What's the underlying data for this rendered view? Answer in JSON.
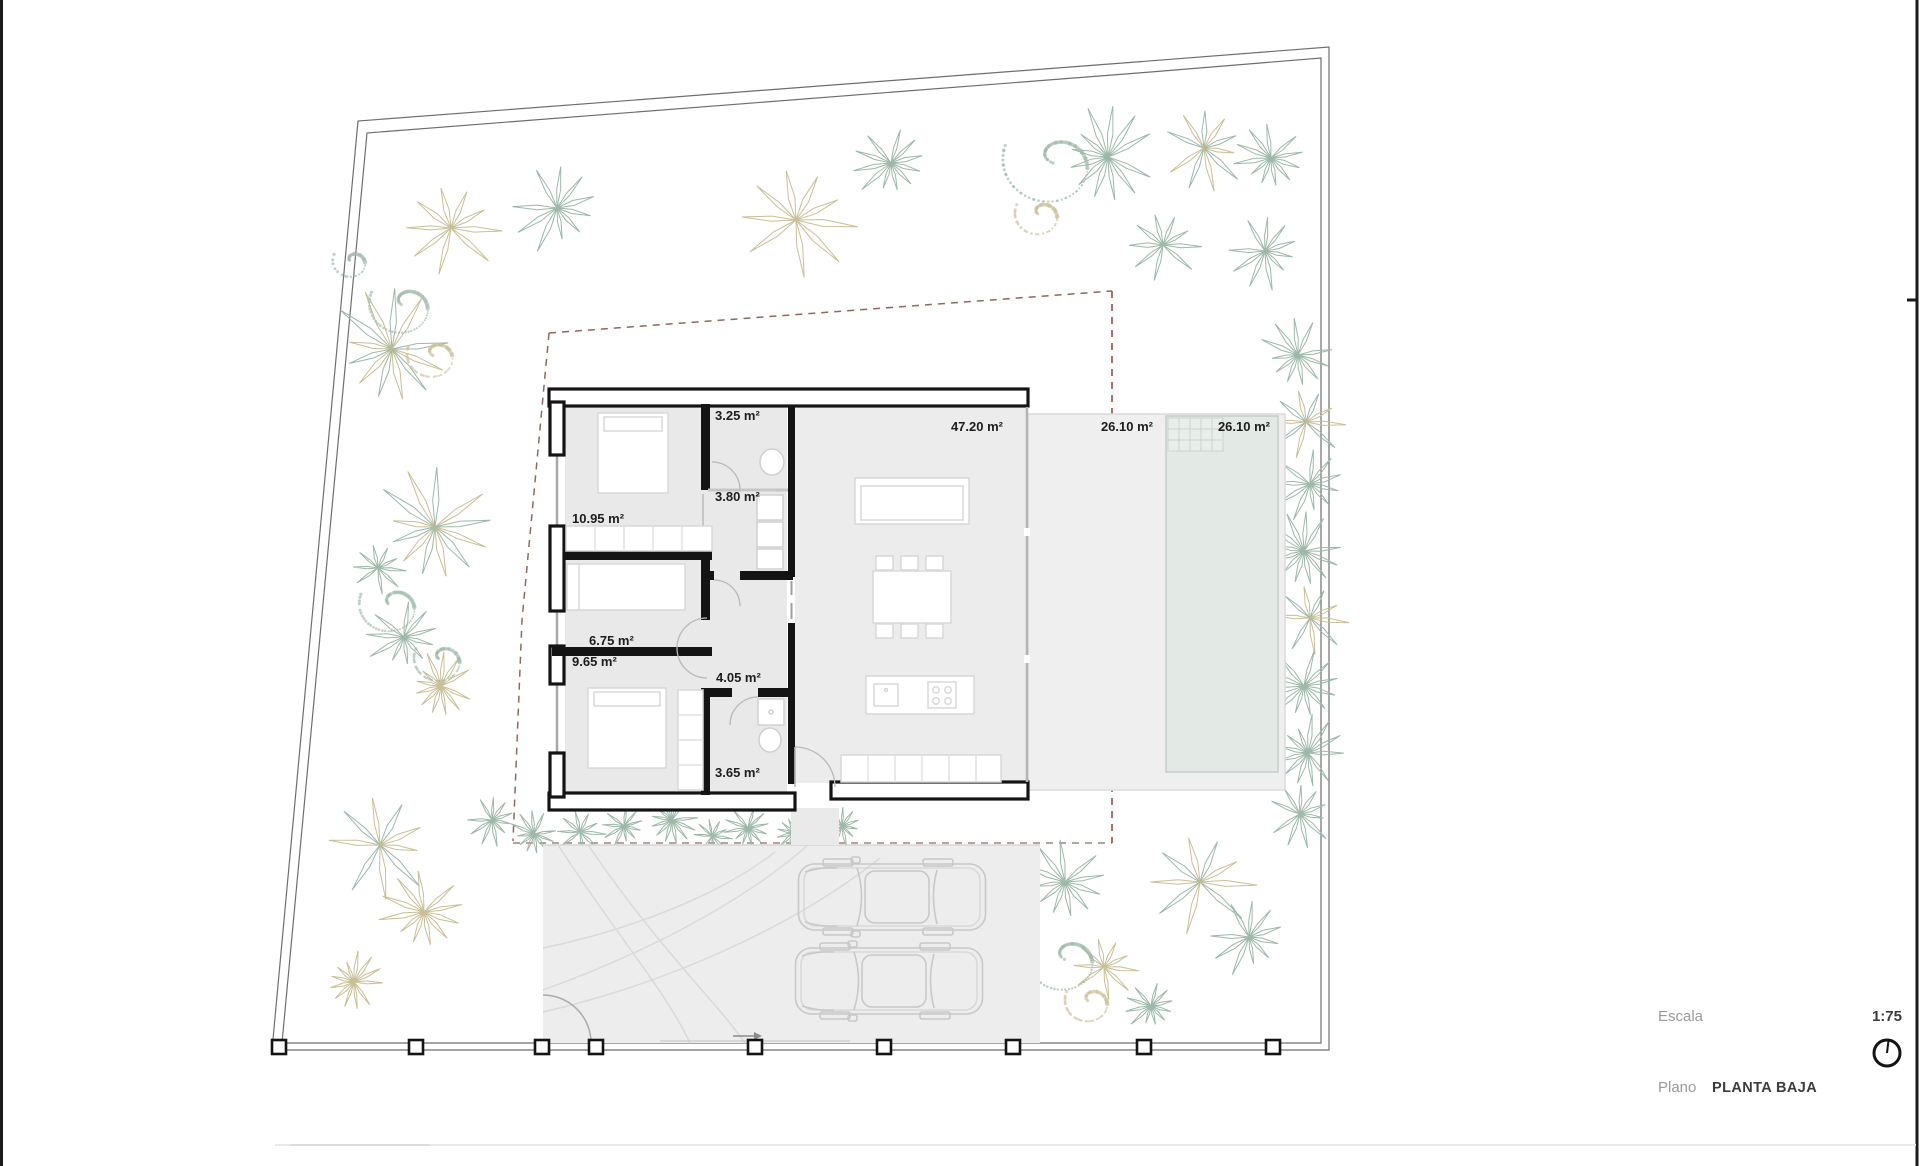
{
  "document": {
    "type": "architectural-floor-plan-sheet"
  },
  "title_block": {
    "escala_label": "Escala",
    "escala_value": "1:75",
    "plano_label": "Plano",
    "plano_value": "PLANTA BAJA",
    "north_icon": "north-compass-circle"
  },
  "plan": {
    "room_labels": [
      {
        "name": "bathroom-1",
        "area": "3.25 m²",
        "x": 715,
        "y": 420,
        "anchor": "start"
      },
      {
        "name": "laundry-hall",
        "area": "3.80 m²",
        "x": 715,
        "y": 501,
        "anchor": "start"
      },
      {
        "name": "bedroom-1",
        "area": "10.95 m²",
        "x": 572,
        "y": 523,
        "anchor": "start"
      },
      {
        "name": "dressing-room",
        "area": "6.75 m²",
        "x": 589,
        "y": 645,
        "anchor": "start"
      },
      {
        "name": "bedroom-2",
        "area": "9.65 m²",
        "x": 572,
        "y": 666,
        "anchor": "start"
      },
      {
        "name": "hallway",
        "area": "4.05 m²",
        "x": 716,
        "y": 682,
        "anchor": "start"
      },
      {
        "name": "bathroom-2",
        "area": "3.65 m²",
        "x": 715,
        "y": 777,
        "anchor": "start"
      },
      {
        "name": "living-kitchen",
        "area": "47.20 m²",
        "x": 1003,
        "y": 431,
        "anchor": "end"
      },
      {
        "name": "terrace",
        "area": "26.10 m²",
        "x": 1153,
        "y": 431,
        "anchor": "end"
      },
      {
        "name": "pool",
        "area": "26.10 m²",
        "x": 1270,
        "y": 431,
        "anchor": "end"
      }
    ]
  },
  "site": {
    "fence_post_y": 1040,
    "fence_post_xs": [
      279,
      416,
      542,
      596,
      755,
      884,
      1013,
      1144,
      1273
    ]
  },
  "decor": {
    "palms": [
      [
        451,
        228,
        52,
        0
      ],
      [
        557,
        208,
        46,
        1
      ],
      [
        392,
        349,
        62,
        2
      ],
      [
        796,
        220,
        60,
        0
      ],
      [
        891,
        163,
        38,
        1
      ],
      [
        1108,
        157,
        50,
        1
      ],
      [
        1204,
        148,
        44,
        2
      ],
      [
        1271,
        158,
        36,
        1
      ],
      [
        1163,
        245,
        40,
        1
      ],
      [
        1265,
        251,
        38,
        1
      ],
      [
        435,
        527,
        62,
        2
      ],
      [
        378,
        568,
        28,
        1
      ],
      [
        404,
        637,
        38,
        1
      ],
      [
        441,
        686,
        34,
        0
      ],
      [
        380,
        845,
        55,
        2
      ],
      [
        424,
        912,
        44,
        0
      ],
      [
        354,
        982,
        30,
        0
      ],
      [
        492,
        820,
        26,
        1
      ],
      [
        534,
        834,
        24,
        1
      ],
      [
        580,
        832,
        26,
        1
      ],
      [
        624,
        826,
        22,
        1
      ],
      [
        672,
        820,
        28,
        1
      ],
      [
        712,
        836,
        20,
        1
      ],
      [
        748,
        828,
        24,
        1
      ],
      [
        794,
        833,
        22,
        1
      ],
      [
        842,
        826,
        22,
        1
      ],
      [
        1298,
        355,
        38,
        1
      ],
      [
        1306,
        422,
        40,
        2
      ],
      [
        1310,
        484,
        38,
        1
      ],
      [
        1304,
        551,
        40,
        1
      ],
      [
        1310,
        618,
        38,
        2
      ],
      [
        1304,
        686,
        40,
        1
      ],
      [
        1308,
        753,
        38,
        1
      ],
      [
        1300,
        814,
        34,
        1
      ],
      [
        1065,
        882,
        44,
        1
      ],
      [
        1200,
        882,
        58,
        2
      ],
      [
        1249,
        937,
        40,
        1
      ],
      [
        943,
        931,
        28,
        1
      ],
      [
        1104,
        967,
        34,
        0
      ],
      [
        1151,
        1006,
        26,
        1
      ]
    ],
    "scrubs": [
      [
        404,
        306,
        36,
        1
      ],
      [
        434,
        356,
        28,
        0
      ],
      [
        352,
        262,
        20,
        1
      ],
      [
        1053,
        163,
        52,
        1
      ],
      [
        1040,
        215,
        26,
        0
      ],
      [
        392,
        606,
        34,
        1
      ],
      [
        441,
        660,
        28,
        1
      ],
      [
        1066,
        960,
        40,
        1
      ],
      [
        1090,
        1002,
        26,
        0
      ],
      [
        862,
        975,
        22,
        1
      ]
    ]
  },
  "colors": {
    "wall": "#141414",
    "floor_bedrooms": "#e9e9e9",
    "floor_living": "#ececec",
    "terrace": "#efefef",
    "pool": "#e3e9e5",
    "boundary": "#6e6e6e",
    "setback_dash": "#8c6a60",
    "setback_dash_red": "#a04a40",
    "vegetation_tan": "#c9bf97",
    "vegetation_green": "#9db8a9",
    "furniture_stroke": "#d8d8d8",
    "car_stroke": "#c8c8c8",
    "label_text": "#1c1c1c",
    "muted_text": "#9a9a9a",
    "dark_text": "#3c3c3c"
  }
}
